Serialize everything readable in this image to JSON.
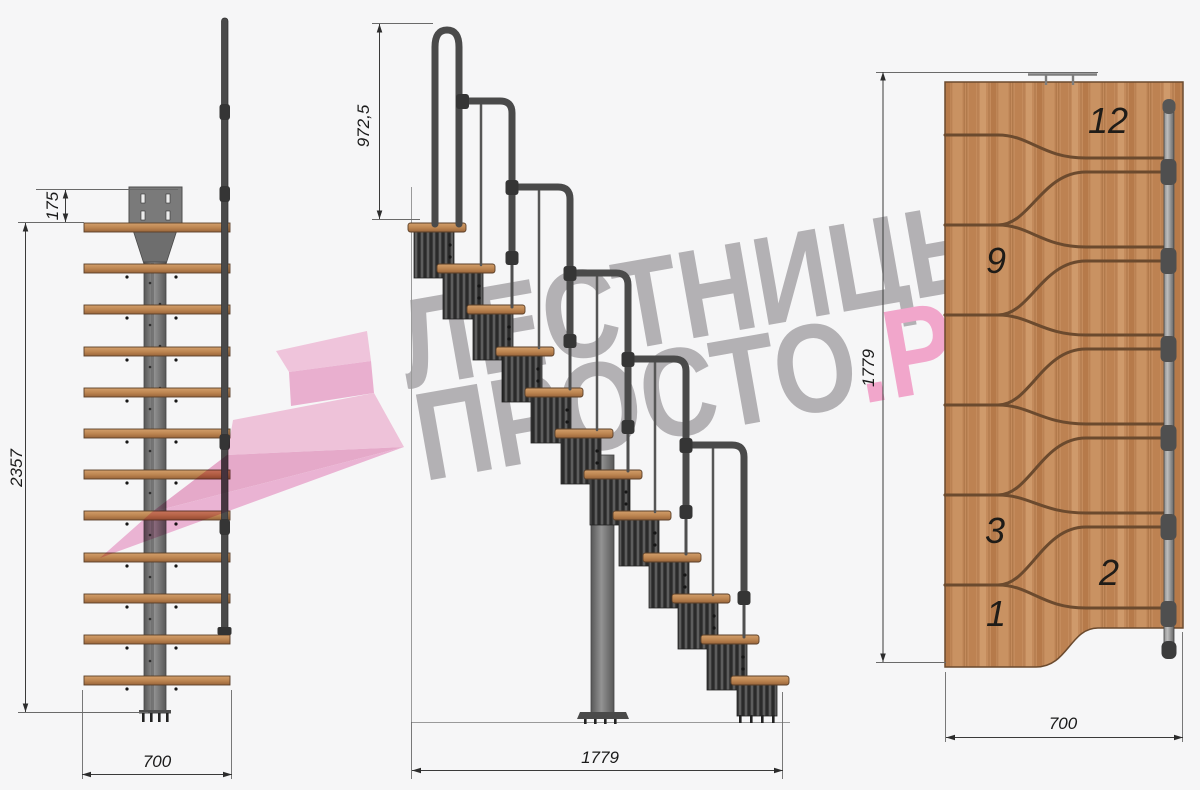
{
  "title": "Чертёж модульной лестницы — три проекции",
  "watermark": {
    "line1": "ЛЕСТНИЦЫ",
    "line2_gray": "ПРОСТО",
    "line2_pink": ".РУ"
  },
  "views": {
    "front": {
      "name": "front-elevation",
      "dims": {
        "top_offset": "175",
        "height": "2357",
        "width": "700"
      },
      "step_count": 12
    },
    "side": {
      "name": "side-elevation",
      "dims": {
        "rail_height": "972,5",
        "length": "1779"
      },
      "step_count": 12,
      "rail_segments": 6
    },
    "plan": {
      "name": "plan-view",
      "dims": {
        "length": "1779",
        "width": "700"
      },
      "step_labels": [
        "12",
        "9",
        "3",
        "2",
        "1"
      ]
    }
  },
  "colors": {
    "bg": "#f6f6f7",
    "wm_gray": "#b3b1b4",
    "wm_pink": "#f1a6cb",
    "dim_text": "#1a1a1a",
    "wood_mid": "#c48b5c",
    "wood_light": "#d2a06e",
    "wood_dark": "#a8703f",
    "metal_dark": "#3b3b3b",
    "metal_mid": "#6f6f6f",
    "logo_pink_1": "#f8c6df",
    "logo_pink_2": "#f1aed2",
    "logo_pink_3": "#f7c3dd",
    "logo_pink_4": "#eda6cb",
    "logo_pink_5": "#f2b3d6"
  }
}
